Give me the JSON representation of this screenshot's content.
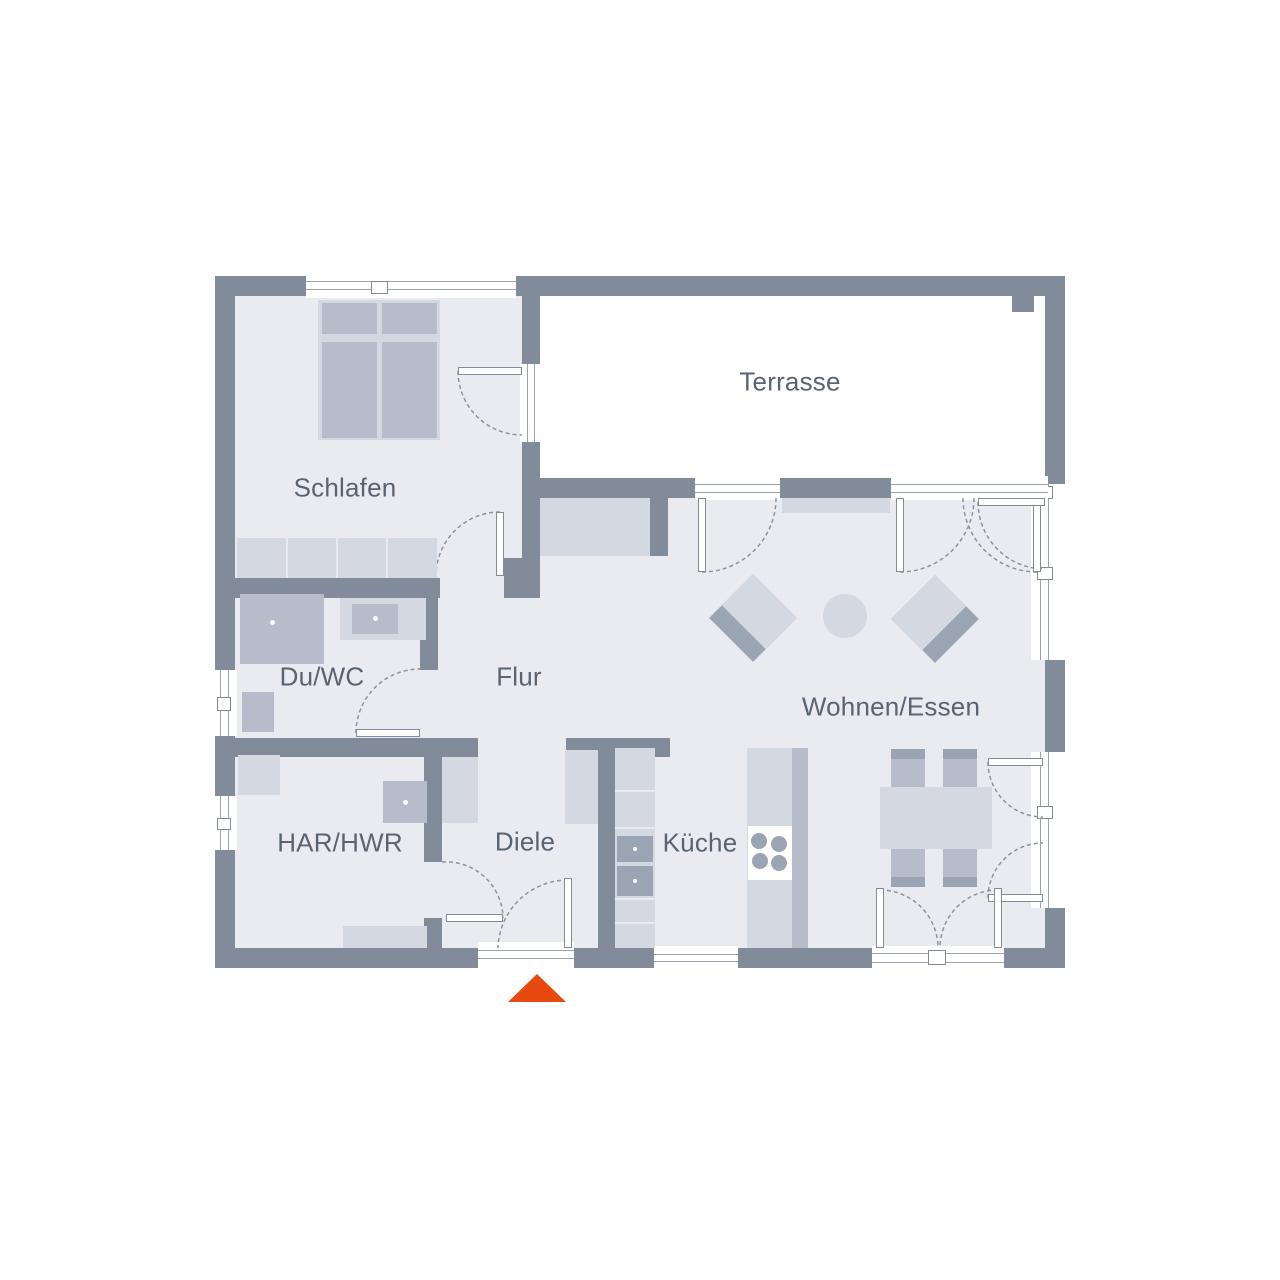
{
  "plan": {
    "title": "floor-plan",
    "rooms": {
      "schlafen": {
        "label": "Schlafen"
      },
      "terrasse": {
        "label": "Terrasse"
      },
      "du_wc": {
        "label": "Du/WC"
      },
      "flur": {
        "label": "Flur"
      },
      "wohnen_essen": {
        "label": "Wohnen/Essen"
      },
      "har_hwr": {
        "label": "HAR/HWR"
      },
      "diele": {
        "label": "Diele"
      },
      "kueche": {
        "label": "Küche"
      }
    },
    "colors": {
      "wall": "#828b99",
      "floor": "#e9ebf1",
      "terrace": "#ffffff",
      "furniture_light": "#d4d8e0",
      "furniture_mid": "#b6bcc9",
      "furniture_dark": "#9ba4b3",
      "frame_line": "#9aa3b0",
      "swing_line": "#8a93a2",
      "label_text": "#5a6372",
      "entrance_accent": "#e8490f"
    },
    "markers": {
      "entrance": "entrance-arrow"
    }
  }
}
